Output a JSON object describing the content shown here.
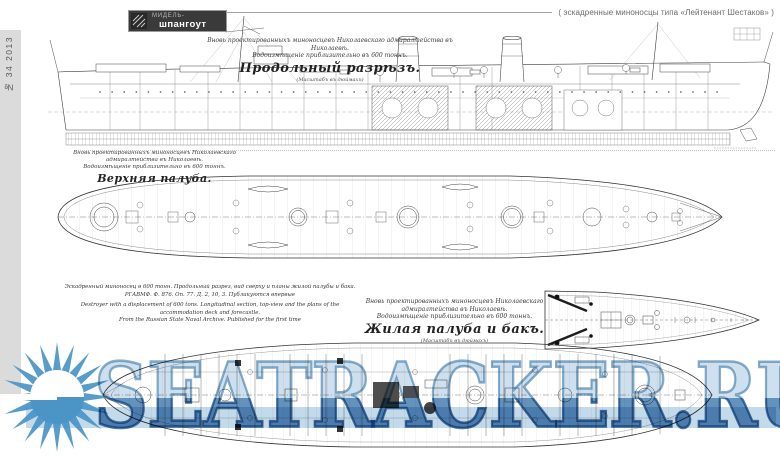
{
  "masthead": {
    "logo": {
      "line1": "МИДЕЛЬ-",
      "line2": "шпангоут"
    },
    "issue": "№ 34  2013",
    "series_title": "( эскадренные миноносцы типа «Лейтенант Шестаков» )"
  },
  "captions": {
    "longitudinal": {
      "line1": "Вновь проектированныхъ миноносцевъ Николаевскаго адмиралтейства въ Николаевѣ.",
      "line2": "Водоизмѣщеніе приблизительно въ 600 тоннъ.",
      "title": "Продольный разрѣзъ.",
      "scale": "(Масштабъ въ дюймахъ)"
    },
    "upper_deck": {
      "line1": "Вновь проектированныхъ миноносцевъ Николаевскаго адмиралтейства въ Николаевѣ.",
      "line2": "Водоизмѣщеніе приблизительно въ 600 тоннъ.",
      "title": "Верхняя палуба.",
      "scale": "(Масштабъ въ дюймахъ)"
    },
    "accommodation": {
      "line1": "Вновь проектированныхъ миноносцевъ Николаевскаго адмиралтейства въ Николаевѣ.",
      "line2": "Водоизмѣщеніе приблизительно въ 600 тоннъ.",
      "title": "Жилая палуба и бакъ.",
      "scale": "(Масштабъ въ дюймахъ)"
    }
  },
  "credit_block": {
    "ru1": "Эскадренный миноносец в 600 тонн. Продольный разрез, вид сверху и планы жилой палубы и бака.",
    "ru2": "РГАВМФ. Ф. 876. Оп. 77. Д. 2, 10, 3. Публикуются впервые",
    "en1": "Destroyer with a displacement of 600 tons. Longitudinal section, top-view and the plans of the accommodation deck and forecastle.",
    "en2": "From the Russian State Naval Archive. Published for the first time"
  },
  "watermark": {
    "text": "SEATRACKER.RU",
    "color": "#4b94c6"
  }
}
